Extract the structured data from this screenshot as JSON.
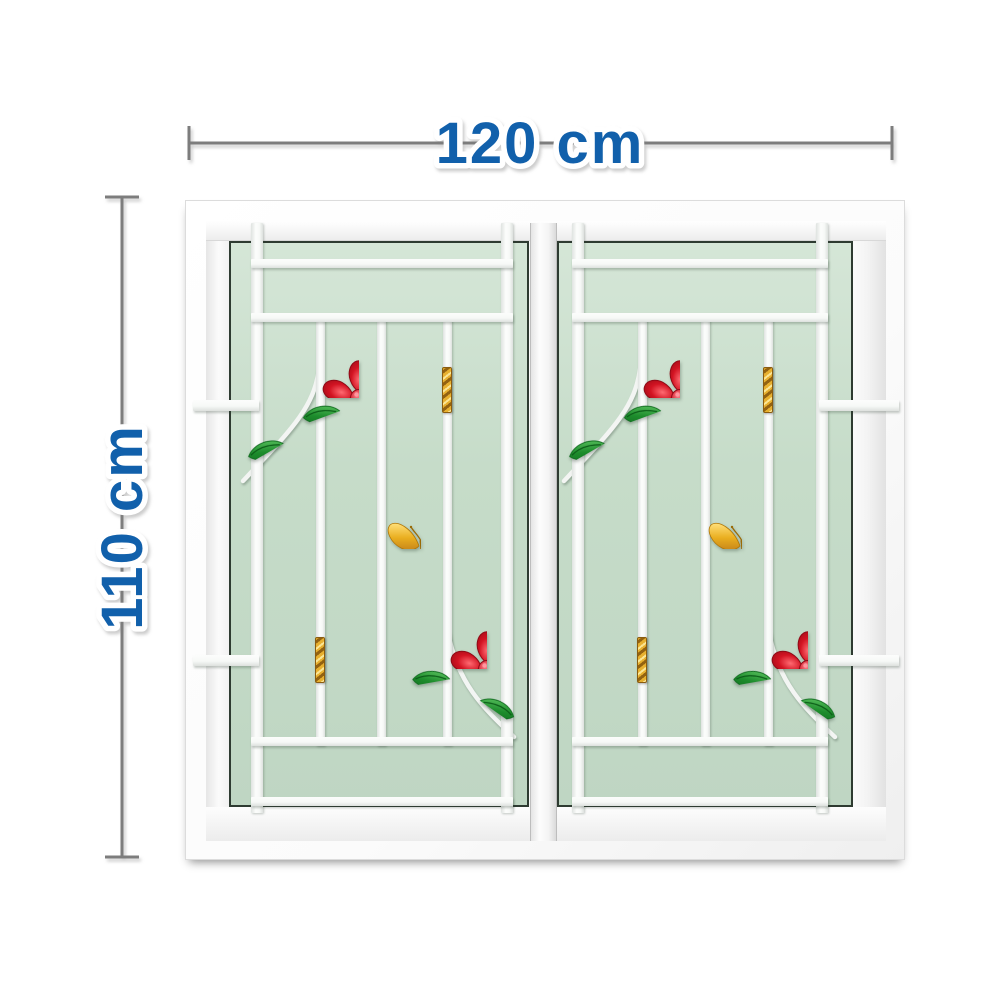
{
  "dimensions": {
    "width_label": "120 cm",
    "height_label": "110 cm"
  },
  "colors": {
    "dim-text": "#1160ab",
    "dim-line": "#7d7d7d",
    "glass": "#c6dcc9",
    "glass-light": "#d5e6d7",
    "glass-edge": "#2e3b31",
    "bar-white": "#f7f9f7",
    "flower-red": "#e2202e",
    "flower-red-dark": "#8f0a16",
    "leaf-green": "#2f9e3c",
    "leaf-green-dark": "#0f6a1e",
    "gold": "#e7b02f",
    "gold-dark": "#8a5c10"
  },
  "window": {
    "sash_count": 2,
    "decorations": [
      "red-flower-icon",
      "green-leaf-icon",
      "white-stem-icon",
      "gold-butterfly-icon",
      "gold-twist-icon"
    ]
  }
}
